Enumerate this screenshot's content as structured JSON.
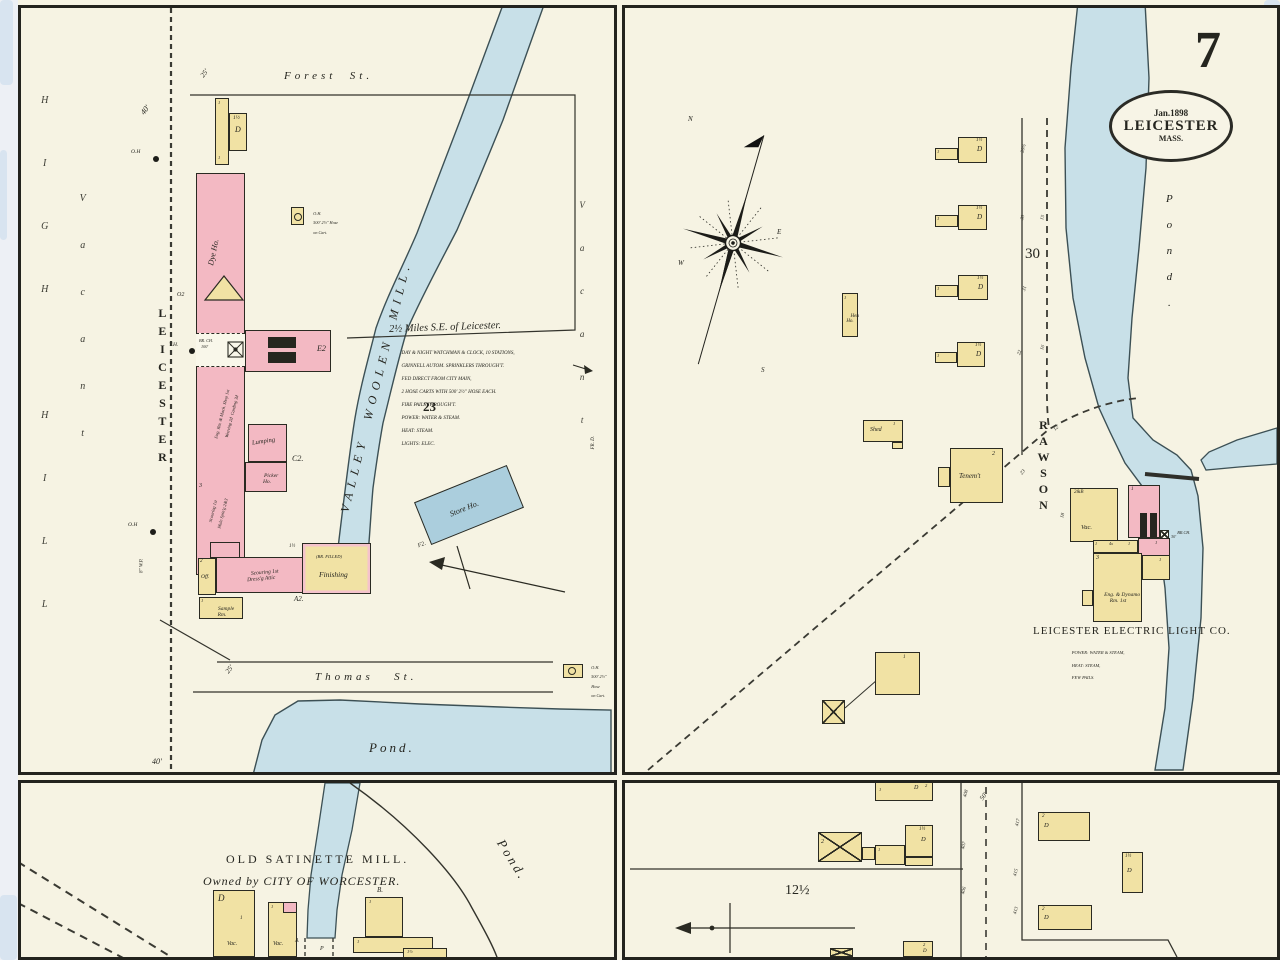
{
  "sheet": {
    "page_number": "7",
    "stamp": {
      "date": "Jan.1898",
      "city": "LEICESTER",
      "state": "MASS."
    }
  },
  "tl": {
    "forest_st": "Forest  St.",
    "thomas_st": "Thomas   St.",
    "leicester_st": "LEICESTER",
    "high_hill": "HIGH HILL",
    "vacant_w": "Vacant",
    "vacant_e": "Vacant",
    "valley_mill": "VALLEY  WOOLEN  MILL.",
    "pond": "Pond.",
    "fr_d": "FR. D.",
    "block_no": "23",
    "title": "2½ Miles S.E. of Leicester.",
    "notes": [
      "DAY & NIGHT WATCHMAN & CLOCK, 10 STATIONS,",
      "GRINNELL AUTOM. SPRINKLERS THROUGH'T.",
      "FED DIRECT FROM CITY MAIN,",
      "2 HOSE CARTS WITH 500' 2½\" HOSE EACH.",
      "FIRE PAILS THROUGH'T.",
      "POWER: WATER & STEAM.",
      "HEAT: STEAM.",
      "LIGHTS: ELEC."
    ],
    "oh_top": [
      "O.H.",
      "500' 2½\" Hose",
      "on Cart."
    ],
    "oh_bot": [
      "O.H.",
      "500' 2½\"",
      "Hose",
      "on Cart."
    ],
    "oh": "O.H",
    "th": "T.H.",
    "wp": "8\" W.P.",
    "d40a": "40'",
    "d40b": "40'",
    "d25a": "25'",
    "d25b": "25'",
    "dw_s": "1½",
    "dw_d": "D",
    "dw_1": "1",
    "dye_ho": "Dye Ho.",
    "o2": "O2",
    "br_ch": [
      "BR. CH.",
      "100'"
    ],
    "eng": [
      "Eng. Rm. & Mach. Shop 1st",
      "Weaving 2d",
      "Carding 3d"
    ],
    "scour": [
      "Scouring 1st",
      "Mule Spin'g",
      "2&3"
    ],
    "floors3": "3",
    "e2": "E2",
    "c2": "C2.",
    "a2": "A2.",
    "f2": "F2.",
    "lumping": "Lumping",
    "picker": [
      "Picker",
      "Ho."
    ],
    "dress": [
      "Scouring 1st",
      "Dress'g Attic"
    ],
    "br_filled": "(BR. FILLED)",
    "finishing": "Finishing",
    "half": "1½",
    "off": "Off.",
    "off_fl": "2",
    "sample": [
      "Sample",
      "Rm."
    ],
    "sample_1": "1",
    "store_ho": "Store Ho."
  },
  "tr": {
    "rawson": "RAWSON",
    "pond": "Pond.",
    "block_no": "30",
    "compass": {
      "n": "N",
      "s": "S",
      "e": "E",
      "w": "W"
    },
    "nums": {
      "a": "30½",
      "b": "30",
      "c": "15",
      "d": "31",
      "e": "22",
      "f": "16",
      "g": "12'",
      "h": "23",
      "i": "18"
    },
    "u_s": "1½",
    "u_d": "D",
    "u_1": "1",
    "hen": [
      "Hen",
      "Ho."
    ],
    "hen_1": "1",
    "shed": "Shed",
    "shed_1": "1",
    "tenement": "Tenem't",
    "tenement_2": "2",
    "vac": "Vac.",
    "fl_2b": "2&B",
    "fl_3": "3",
    "fl_1": "1",
    "x4": "4x",
    "eng_dynamo": [
      "Eng. & Dynamo",
      "Rm. 1st"
    ],
    "br_ch": [
      "BR.CH.",
      "30'"
    ],
    "company": "LEICESTER ELECTRIC LIGHT CO.",
    "co_notes": [
      "POWER: WATER & STEAM,",
      "HEAT: STEAM,",
      "FEW PAILS."
    ],
    "sw_1": "1"
  },
  "bl": {
    "headline1": "OLD SATINETTE MILL.",
    "headline2": "Owned by CITY OF WORCESTER.",
    "pond": "Pond.",
    "vac": "Vac.",
    "d": "D",
    "b": "B.",
    "one": "1",
    "half": "1½",
    "a": "A",
    "p": "P"
  },
  "br": {
    "block_no": "12½",
    "road_w": "50'",
    "nums": {
      "a": "408",
      "b": "407",
      "c": "406",
      "d": "417",
      "e": "415",
      "f": "413"
    },
    "two": "2",
    "dee": "D",
    "half": "1½",
    "one": "1"
  }
}
